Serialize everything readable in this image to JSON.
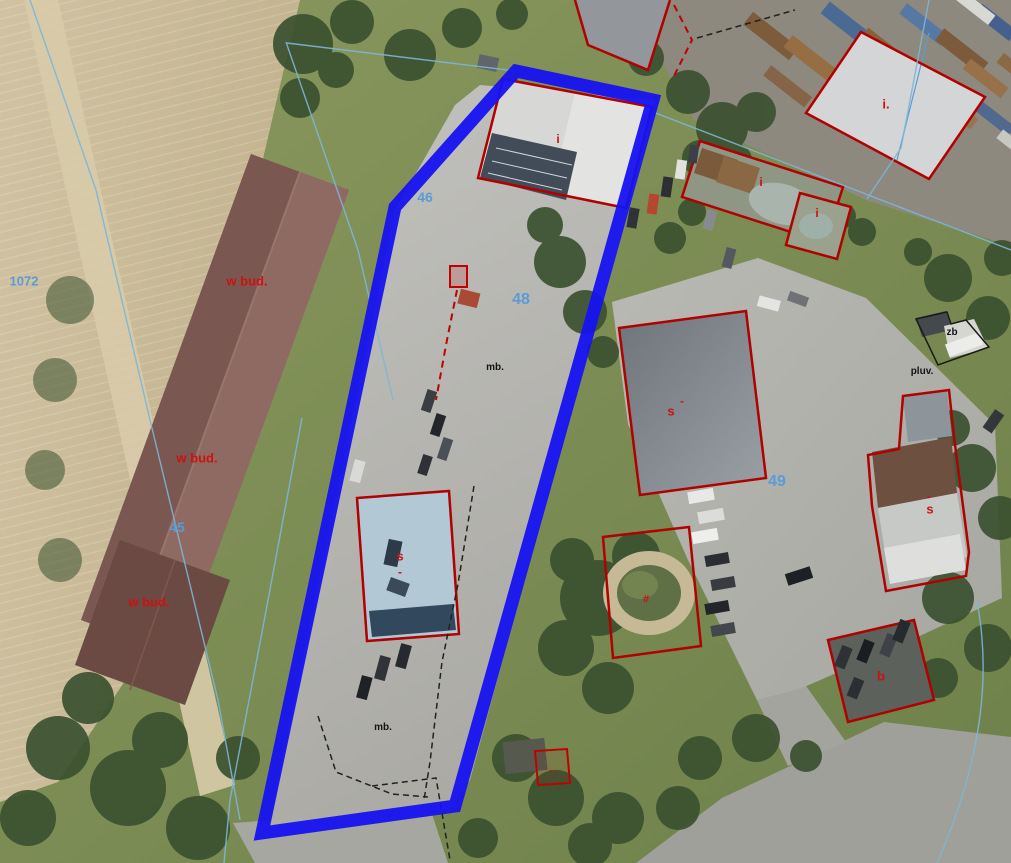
{
  "map": {
    "description": "Aerial cadastral orthophoto with highlighted parcel and building outlines",
    "highlighted_parcel": "48",
    "parcel_numbers": {
      "p1072": "1072",
      "p45": "45",
      "p46": "46",
      "p48": "48",
      "p49": "49"
    },
    "building_annotations": {
      "w_bud_1": "w bud.",
      "w_bud_2": "w bud.",
      "w_bud_3": "w bud.",
      "i_warehouse": "i",
      "i_hall": "i.",
      "i_pond_long": "i",
      "i_pond_small": "i",
      "s_center": "s",
      "s_center_dash": "-",
      "s_blue": "s",
      "s_blue_dash": "-",
      "s_right": "s",
      "s_right_dash": "-",
      "b_parking": "b",
      "zb_shed": "zb",
      "pond_mark": "#",
      "shed_mark": "-"
    },
    "ground_annotations": {
      "mb_1": "mb.",
      "mb_2": "mb.",
      "pluv": "pluv."
    },
    "colors": {
      "highlight_boundary": "#1612f0",
      "parcel_line": "#7db6d6",
      "building_outline": "#b40000",
      "parcel_number_text": "#5b9bd5",
      "annotation_red": "#cc1111",
      "annotation_black": "#141414"
    }
  }
}
